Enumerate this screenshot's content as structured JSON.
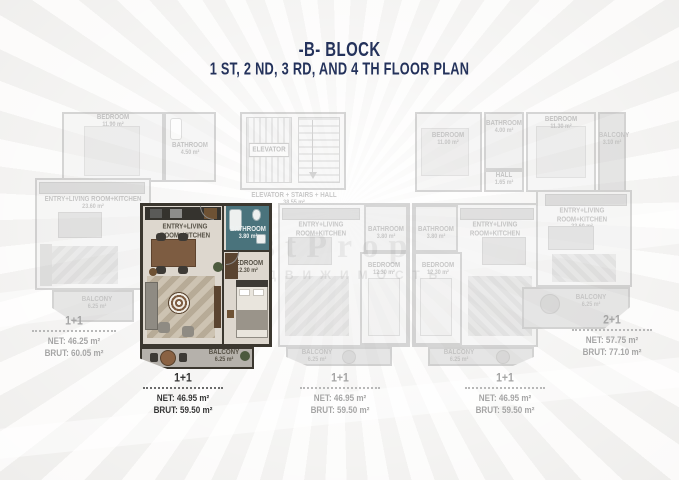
{
  "title": {
    "line1": "-B- BLOCK",
    "line2": "1 ST, 2 ND, 3 RD, AND 4 TH FLOOR PLAN"
  },
  "watermark": {
    "latin": "stProp",
    "cyrillic": "НЕДВИЖИМОСТЬ"
  },
  "colors": {
    "title_navy": "#24325b",
    "highlight_wall": "#3b372f",
    "bathroom_floor": "#4a737c",
    "wood_accent": "#7d5c41",
    "faded_gray": "#a2a09d"
  },
  "core": {
    "elevator": "ELEVATOR",
    "caption": "ELEVATOR + STAIRS + HALL",
    "area": "38.55 m²"
  },
  "units": {
    "left": {
      "type": "1+1",
      "net": "NET: 46.25 m²",
      "brut": "BRUT: 60.05 m²",
      "bedroom": "BEDROOM",
      "bedroom_area": "11.90 m²",
      "bathroom": "BATHROOM",
      "bathroom_area": "4.50 m²",
      "living": "ENTRY+LIVING ROOM+KITCHEN",
      "living_area": "23.60 m²",
      "balcony": "BALCONY",
      "balcony_area": "6.25 m²"
    },
    "highlighted": {
      "type": "1+1",
      "net": "NET: 46.95 m²",
      "brut": "BRUT: 59.50 m²",
      "living": "ENTRY+LIVING ROOM+KITCHEN",
      "living_area": "24.60 m²",
      "bathroom": "BATHROOM",
      "bathroom_area": "3.80 m²",
      "bedroom": "BEDROOM",
      "bedroom_area": "12.30 m²",
      "balcony": "BALCONY",
      "balcony_area": "6.25 m²"
    },
    "mid1": {
      "type": "1+1",
      "net": "NET: 46.95 m²",
      "brut": "BRUT: 59.50 m²",
      "living": "ENTRY+LIVING ROOM+KITCHEN",
      "living_area": "24.60 m²",
      "bathroom": "BATHROOM",
      "bathroom_area": "3.80 m²",
      "bedroom": "BEDROOM",
      "bedroom_area": "12.30 m²",
      "balcony": "BALCONY",
      "balcony_area": "6.25 m²"
    },
    "mid2": {
      "type": "1+1",
      "net": "NET: 46.95 m²",
      "brut": "BRUT: 59.50 m²",
      "living": "ENTRY+LIVING ROOM+KITCHEN",
      "living_area": "24.60 m²",
      "bathroom": "BATHROOM",
      "bathroom_area": "3.80 m²",
      "bedroom": "BEDROOM",
      "bedroom_area": "12.30 m²",
      "balcony": "BALCONY",
      "balcony_area": "6.25 m²"
    },
    "right": {
      "type": "2+1",
      "net": "NET: 57.75 m²",
      "brut": "BRUT: 77.10 m²",
      "bedroom1": "BEDROOM",
      "bedroom1_area": "11.00 m²",
      "bathroom": "BATHROOM",
      "bathroom_area": "4.00 m²",
      "bedroom2": "BEDROOM",
      "bedroom2_area": "11.30 m²",
      "hall": "HALL",
      "hall_area": "1.65 m²",
      "side_balcony": "BALCONY",
      "side_balcony_area": "3.10 m²",
      "living": "ENTRY+LIVING ROOM+KITCHEN",
      "living_area": "23.60 m²",
      "balcony": "BALCONY",
      "balcony_area": "6.25 m²"
    }
  }
}
